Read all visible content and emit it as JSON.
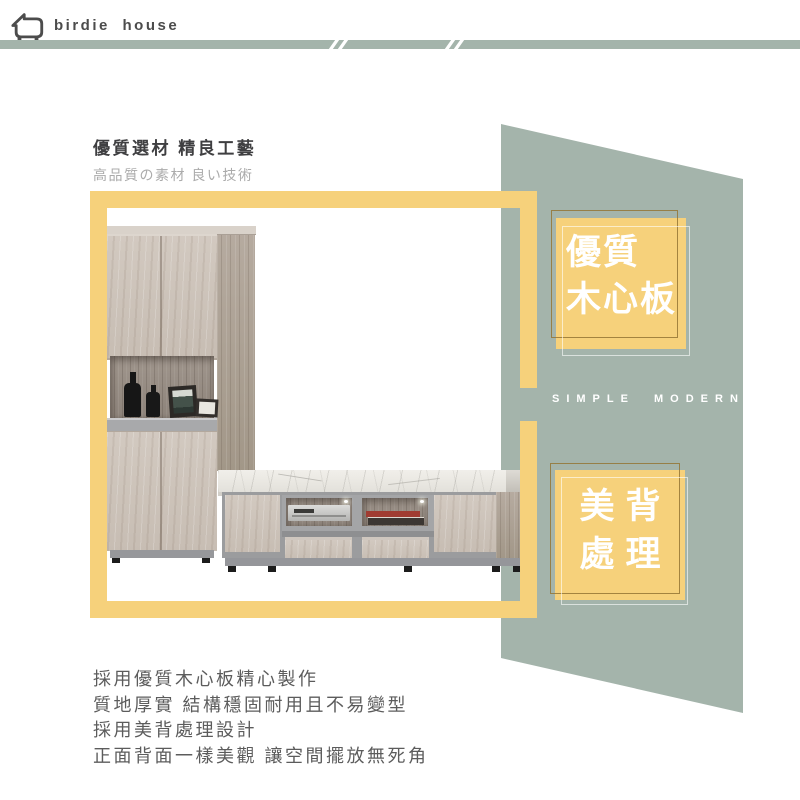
{
  "brand": {
    "name": "birdie house"
  },
  "intro": {
    "title": "優質選材 精良工藝",
    "subtitle": "高品質の素材 良い技術"
  },
  "badges": [
    {
      "line1": "優質",
      "line2": "木心板"
    },
    {
      "line1": "美背",
      "line2": "處理"
    }
  ],
  "decor": {
    "tagline": "SIMPLE MODERN"
  },
  "description": {
    "lines": [
      "採用優質木心板精心製作",
      "質地厚實 結構穩固耐用且不易變型",
      "採用美背處理設計",
      "正面背面一樣美觀 讓空間擺放無死角"
    ]
  },
  "icons": {
    "logo": "birdie-house-logo-icon",
    "band_marks": "double-slash-icon"
  },
  "colors": {
    "sage": "#a4b4ab",
    "accent_yellow": "#f6d17b",
    "badge_outline": "#a98d4e",
    "title_text": "#3f3f41",
    "subtitle_text": "#ababab",
    "body_text": "#5c5c5c",
    "logo_text": "#4c4c4c"
  }
}
